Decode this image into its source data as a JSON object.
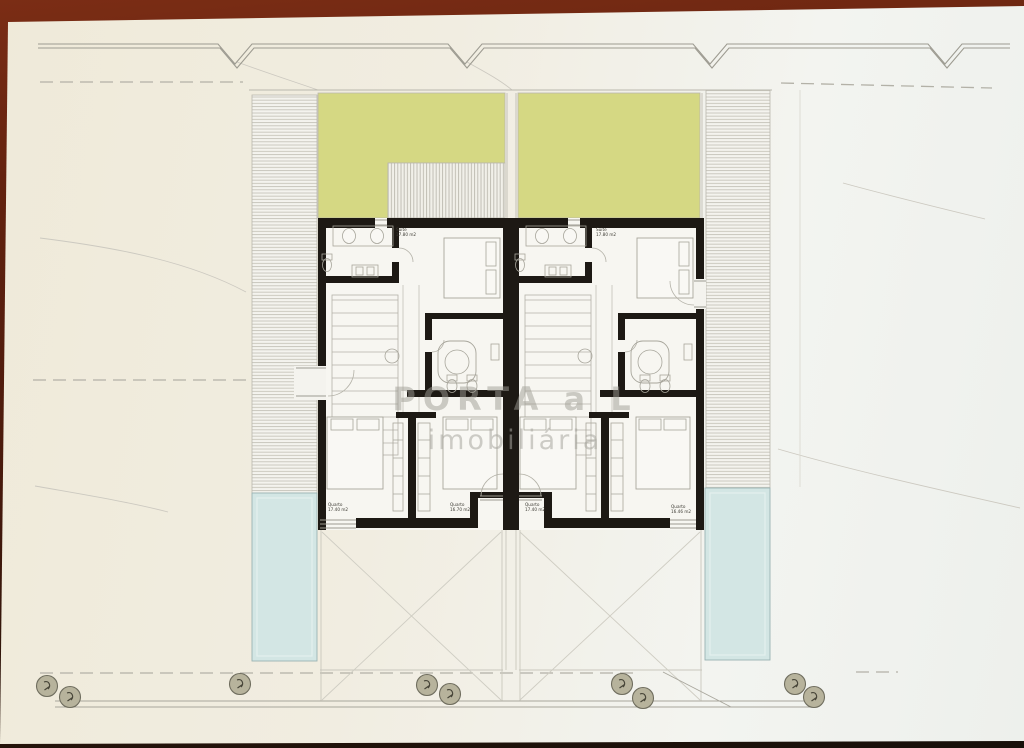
{
  "watermark": {
    "line1": "PORTA a L",
    "line2": "imobiliária"
  },
  "plan": {
    "units": [
      {
        "rooms": [
          {
            "label": "Suite",
            "area": "17.80 m2"
          },
          {
            "label": "Quarto",
            "area": "17.40 m2"
          },
          {
            "label": "Quarto",
            "area": "16.70 m2"
          }
        ]
      },
      {
        "rooms": [
          {
            "label": "Suite",
            "area": "17.80 m2"
          },
          {
            "label": "Quarto",
            "area": "17.40 m2"
          },
          {
            "label": "Quarto",
            "area": "16.46 m2"
          }
        ]
      }
    ]
  },
  "site": {
    "tree_markers": 9,
    "boundary_notches": 4
  },
  "colors": {
    "photo_border": "#5f2110",
    "paper": "#f1ede1",
    "wall": "#1d1914",
    "garden_green": "#d5d883",
    "pool_blue": "#d3e6e4",
    "drawing_line": "#9d9b91",
    "watermark_gray": "#a9a7a0"
  }
}
